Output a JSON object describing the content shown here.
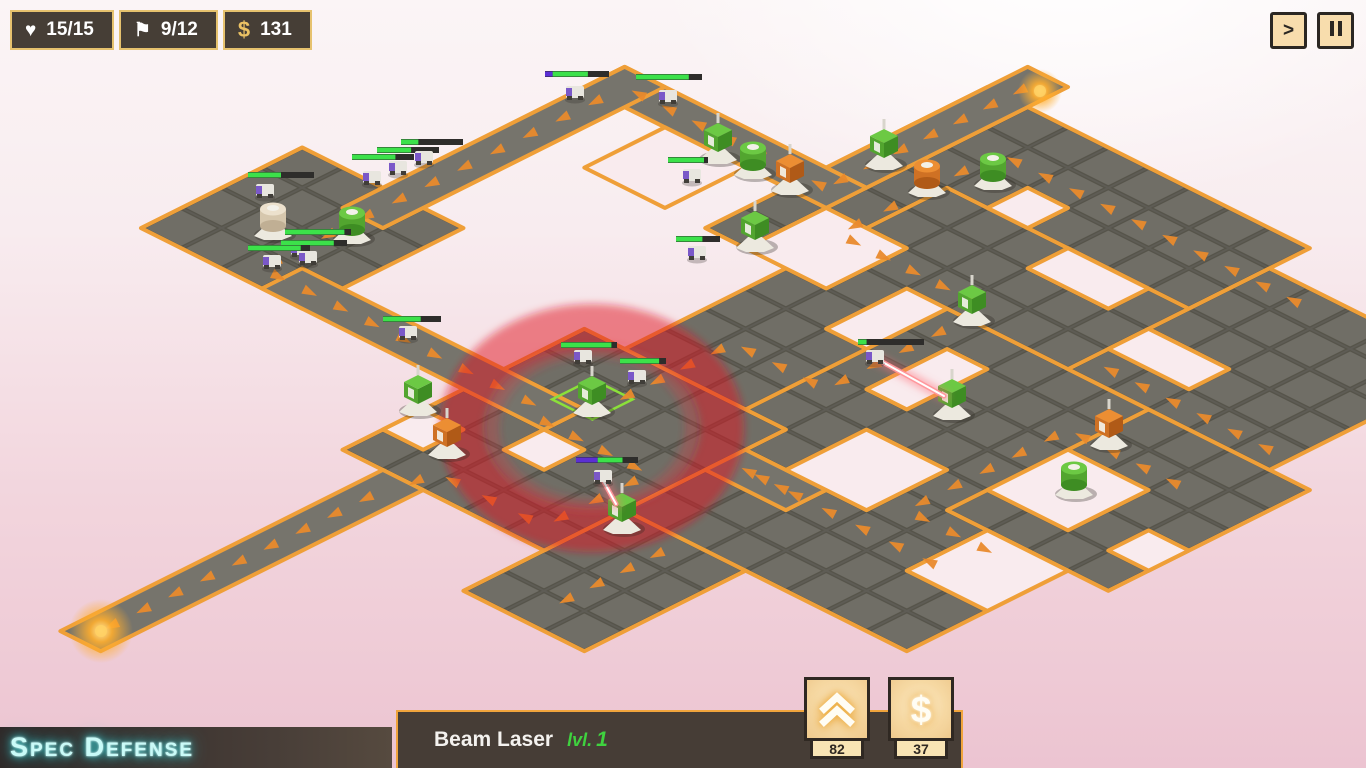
{
  "hud": {
    "lives": {
      "icon": "heart-icon",
      "value": "15/15"
    },
    "waves": {
      "icon": "flag-icon",
      "value": "9/12"
    },
    "money": {
      "icon": "dollar-icon",
      "value": "131"
    }
  },
  "speed_controls": {
    "fast_forward_label": ">",
    "pause_label": "||"
  },
  "branding": {
    "title": "Spec Defense"
  },
  "tower_panel": {
    "name": "Beam Laser",
    "level_prefix": "lvl.",
    "level": "1",
    "upgrade_cost": "82",
    "sell_price": "37"
  },
  "colors": {
    "accent_orange": "#ef9f38",
    "arrow_orange": "#e98a2c",
    "hud_gold": "#e6c26e",
    "panel_brown": "#463d36",
    "board_gray": "#706e66",
    "road_gray": "#76746c",
    "hp_green": "#3ce14a",
    "shield_purple": "#5b2fd4",
    "ring_red": "#e11623",
    "logo_cyan": "#c9fbf8",
    "button_tan": "#f6d9a4"
  },
  "map": {
    "origin": [
      1068,
      87
    ],
    "tile": 57,
    "pieces": [
      {
        "kind": "grid",
        "rect": [
          -1,
          1,
          7,
          8
        ]
      },
      {
        "kind": "grid",
        "rect": [
          1,
          4,
          9,
          13
        ]
      },
      {
        "kind": "grid",
        "rect": [
          4,
          7,
          12,
          16
        ]
      },
      {
        "kind": "grid",
        "rect": [
          9,
          7,
          13,
          12
        ]
      },
      {
        "kind": "grid",
        "rect": [
          7,
          2,
          12,
          7
        ]
      },
      {
        "kind": "grid",
        "rect": [
          5,
          16,
          8,
          20
        ]
      },
      {
        "kind": "grid",
        "rect": [
          -8,
          11,
          -4,
          15
        ]
      },
      {
        "kind": "grid",
        "rect": [
          0,
          12,
          5,
          18
        ]
      },
      {
        "kind": "road",
        "rect": [
          -1,
          0,
          0,
          5
        ]
      },
      {
        "kind": "road",
        "rect": [
          -6,
          5,
          0,
          6
        ]
      },
      {
        "kind": "road",
        "rect": [
          -6,
          5,
          -5,
          12
        ]
      },
      {
        "kind": "road",
        "rect": [
          -5,
          14,
          2,
          15
        ]
      },
      {
        "kind": "road",
        "rect": [
          1,
          18,
          2,
          26
        ]
      },
      {
        "kind": "road",
        "rect": [
          5,
          13,
          7,
          14
        ]
      }
    ],
    "holes": [
      [
        -4,
        6,
        -2,
        8
      ],
      [
        0,
        6,
        2,
        8
      ],
      [
        2,
        3,
        3,
        4
      ],
      [
        4,
        4,
        6,
        5
      ],
      [
        7,
        5,
        9,
        6
      ],
      [
        3,
        7,
        4,
        9
      ],
      [
        9,
        9,
        11,
        11
      ],
      [
        6,
        11,
        8,
        13
      ],
      [
        10,
        12,
        12,
        14
      ],
      [
        12,
        10,
        13,
        11
      ],
      [
        2,
        15,
        3,
        16
      ],
      [
        0,
        16,
        1,
        17
      ],
      [
        5,
        8,
        6,
        10
      ]
    ],
    "arrow_paths": [
      [
        [
          -0.5,
          0.3
        ],
        [
          -0.5,
          5.5
        ]
      ],
      [
        [
          -0.3,
          5.5
        ],
        [
          -5.5,
          5.5
        ]
      ],
      [
        [
          -5.5,
          5.8
        ],
        [
          -5.5,
          12.3
        ]
      ],
      [
        [
          -5.5,
          12.5
        ],
        [
          -5.5,
          14.5
        ],
        [
          1.5,
          14.5
        ]
      ],
      [
        [
          1.5,
          14.8
        ],
        [
          4.4,
          14.8
        ],
        [
          4.4,
          17.4
        ],
        [
          1.7,
          17.4
        ],
        [
          1.7,
          18.3
        ]
      ],
      [
        [
          1.5,
          18.5
        ],
        [
          1.5,
          25.6
        ]
      ],
      [
        [
          6.8,
          13.5
        ],
        [
          5.2,
          13.5
        ]
      ],
      [
        [
          8.5,
          2.5
        ],
        [
          0.8,
          2.5
        ]
      ],
      [
        [
          0.8,
          3.0
        ],
        [
          0.8,
          6.5
        ],
        [
          4.5,
          6.5
        ],
        [
          4.5,
          10.5
        ],
        [
          2.2,
          10.5
        ],
        [
          2.2,
          13.5
        ]
      ],
      [
        [
          11.5,
          8.5
        ],
        [
          8.5,
          8.5
        ],
        [
          8.5,
          12.5
        ],
        [
          10.8,
          12.5
        ]
      ],
      [
        [
          10.5,
          13.5
        ],
        [
          5.5,
          13.5
        ]
      ],
      [
        [
          6.5,
          16.3
        ],
        [
          6.5,
          19.3
        ]
      ],
      [
        [
          11.8,
          6.5
        ],
        [
          7.2,
          6.5
        ]
      ]
    ],
    "selected_tile": [
      1.35,
      13.15,
      2.35,
      14.15
    ],
    "range_ring": {
      "cx": 592,
      "cy": 428,
      "rx": 130,
      "ry": 102
    },
    "towers": [
      {
        "x": 273,
        "y": 222,
        "shape": "round",
        "color": "tan"
      },
      {
        "x": 352,
        "y": 226,
        "shape": "round",
        "color": "green"
      },
      {
        "x": 418,
        "y": 398,
        "shape": "box",
        "color": "green"
      },
      {
        "x": 447,
        "y": 441,
        "shape": "box",
        "color": "orange"
      },
      {
        "x": 592,
        "y": 399,
        "shape": "box",
        "color": "green",
        "selected": true
      },
      {
        "x": 622,
        "y": 516,
        "shape": "box",
        "color": "green"
      },
      {
        "x": 718,
        "y": 146,
        "shape": "box",
        "color": "green"
      },
      {
        "x": 753,
        "y": 161,
        "shape": "round",
        "color": "green"
      },
      {
        "x": 790,
        "y": 177,
        "shape": "box",
        "color": "orange"
      },
      {
        "x": 755,
        "y": 234,
        "shape": "box",
        "color": "green"
      },
      {
        "x": 884,
        "y": 152,
        "shape": "box",
        "color": "green"
      },
      {
        "x": 927,
        "y": 179,
        "shape": "round",
        "color": "orange"
      },
      {
        "x": 993,
        "y": 172,
        "shape": "round",
        "color": "green"
      },
      {
        "x": 972,
        "y": 308,
        "shape": "box",
        "color": "green"
      },
      {
        "x": 952,
        "y": 402,
        "shape": "box",
        "color": "green"
      },
      {
        "x": 1109,
        "y": 432,
        "shape": "box",
        "color": "orange"
      },
      {
        "x": 1074,
        "y": 481,
        "shape": "round",
        "color": "green"
      }
    ],
    "enemies": [
      {
        "x": 575,
        "y": 93,
        "bar": [
          545,
          71,
          64
        ],
        "hp": 0.55,
        "shield": 0.12
      },
      {
        "x": 668,
        "y": 97,
        "bar": [
          636,
          74,
          66
        ],
        "hp": 0.8,
        "shield": 0
      },
      {
        "x": 265,
        "y": 191,
        "bar": [
          248,
          172,
          66
        ],
        "hp": 0.5,
        "shield": 0
      },
      {
        "x": 372,
        "y": 178,
        "bar": [
          352,
          154,
          62
        ],
        "hp": 0.7,
        "shield": 0
      },
      {
        "x": 398,
        "y": 168,
        "bar": [
          377,
          147,
          62
        ],
        "hp": 0.55,
        "shield": 0
      },
      {
        "x": 424,
        "y": 158,
        "bar": [
          401,
          139,
          62
        ],
        "hp": 0.28,
        "shield": 0
      },
      {
        "x": 300,
        "y": 250,
        "bar": [
          285,
          229,
          66
        ],
        "hp": 0.9,
        "shield": 0
      },
      {
        "x": 308,
        "y": 258,
        "bar": [
          281,
          240,
          66
        ],
        "hp": 0.8,
        "shield": 0
      },
      {
        "x": 272,
        "y": 262,
        "bar": [
          248,
          245,
          62
        ],
        "hp": 0.85,
        "shield": 0
      },
      {
        "x": 583,
        "y": 357,
        "bar": [
          561,
          342,
          56
        ],
        "hp": 0.9,
        "shield": 0
      },
      {
        "x": 637,
        "y": 377,
        "bar": [
          620,
          358,
          46
        ],
        "hp": 0.85,
        "shield": 0
      },
      {
        "x": 603,
        "y": 477,
        "bar": [
          576,
          457,
          62
        ],
        "hp": 0.4,
        "shield": 0.35
      },
      {
        "x": 875,
        "y": 357,
        "bar": [
          858,
          339,
          66
        ],
        "hp": 0.13,
        "shield": 0
      },
      {
        "x": 692,
        "y": 176,
        "bar": [
          668,
          157,
          40
        ],
        "hp": 0.9,
        "shield": 0
      },
      {
        "x": 697,
        "y": 253,
        "bar": [
          676,
          236,
          44
        ],
        "hp": 0.6,
        "shield": 0
      },
      {
        "x": 408,
        "y": 333,
        "bar": [
          383,
          316,
          58
        ],
        "hp": 0.65,
        "shield": 0
      }
    ],
    "lasers": [
      [
        616,
        504,
        604,
        482
      ],
      [
        944,
        396,
        877,
        359
      ]
    ],
    "glows": [
      {
        "x": 101,
        "y": 631,
        "r": 32
      },
      {
        "x": 1040,
        "y": 91,
        "r": 22
      }
    ]
  }
}
